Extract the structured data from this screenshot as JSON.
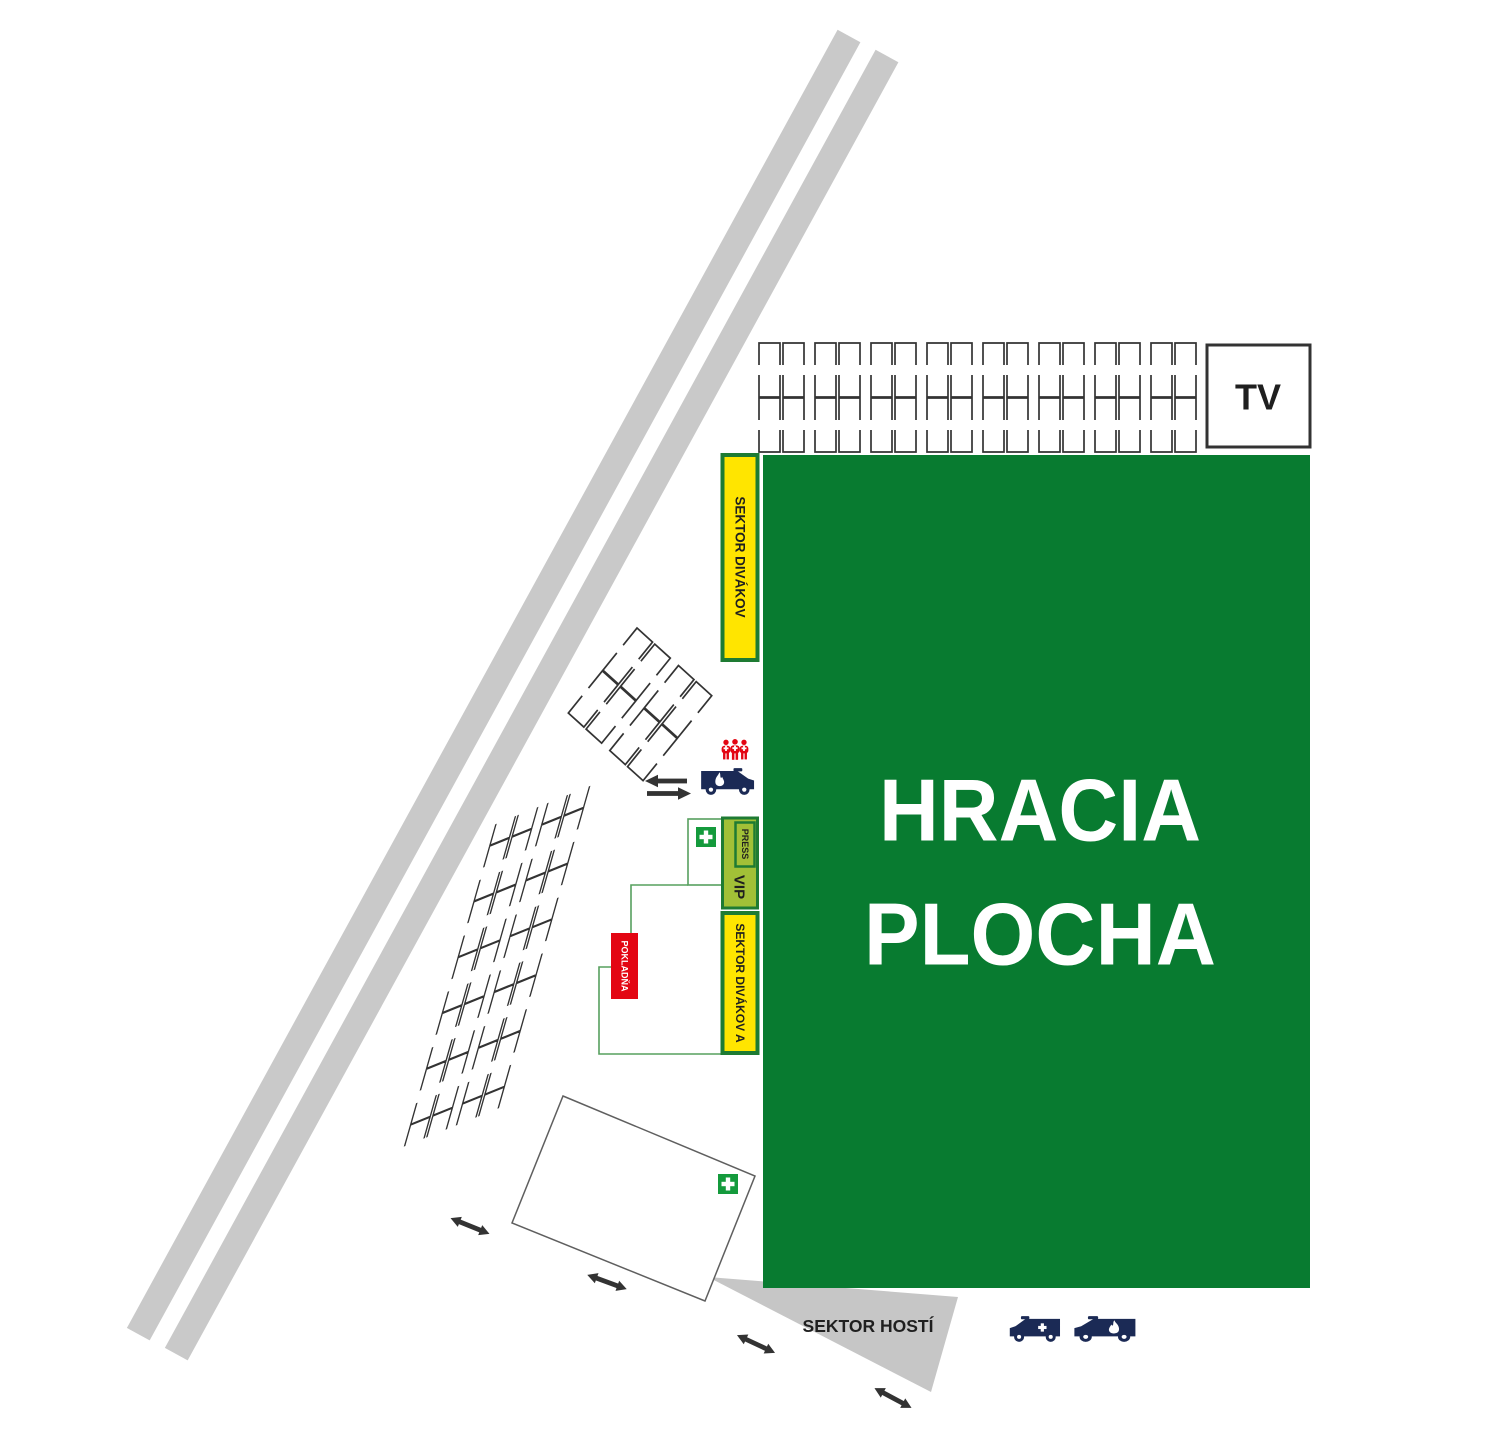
{
  "labels": {
    "playing_field_line1": "HRACIA",
    "playing_field_line2": "PLOCHA",
    "tv": "TV",
    "spectator_sector": "SEKTOR DIVÁKOV",
    "spectator_sector_a": "SEKTOR DIVÁKOV A",
    "press": "PRESS",
    "vip": "VIP",
    "ticket_office": "POKLADŇA",
    "guest_sector": "SEKTOR HOSTÍ"
  },
  "icons": {
    "first_aid": "first-aid-cross-icon",
    "ambulance": "ambulance-van-icon",
    "fire_truck": "fire-truck-van-icon",
    "crowd": "medic-crowd-icon",
    "two_way_arrow": "two-way-arrow-icon",
    "left_arrow": "left-arrow-icon",
    "right_arrow": "right-arrow-icon"
  },
  "colors": {
    "field_green": "#087b30",
    "dark_green_border": "#1e7b33",
    "path_green": "#57a05f",
    "first_aid_green": "#149a3c",
    "yellow": "#ffe500",
    "vip_green": "#a2c037",
    "red": "#e30613",
    "navy": "#1b2a55",
    "road_gray": "#c9c9c9",
    "wedge_gray": "#c6c6c6",
    "outline_dark": "#333333",
    "building_outline": "#5f5f5f",
    "text_dark": "#1f1f1f",
    "white": "#ffffff"
  }
}
